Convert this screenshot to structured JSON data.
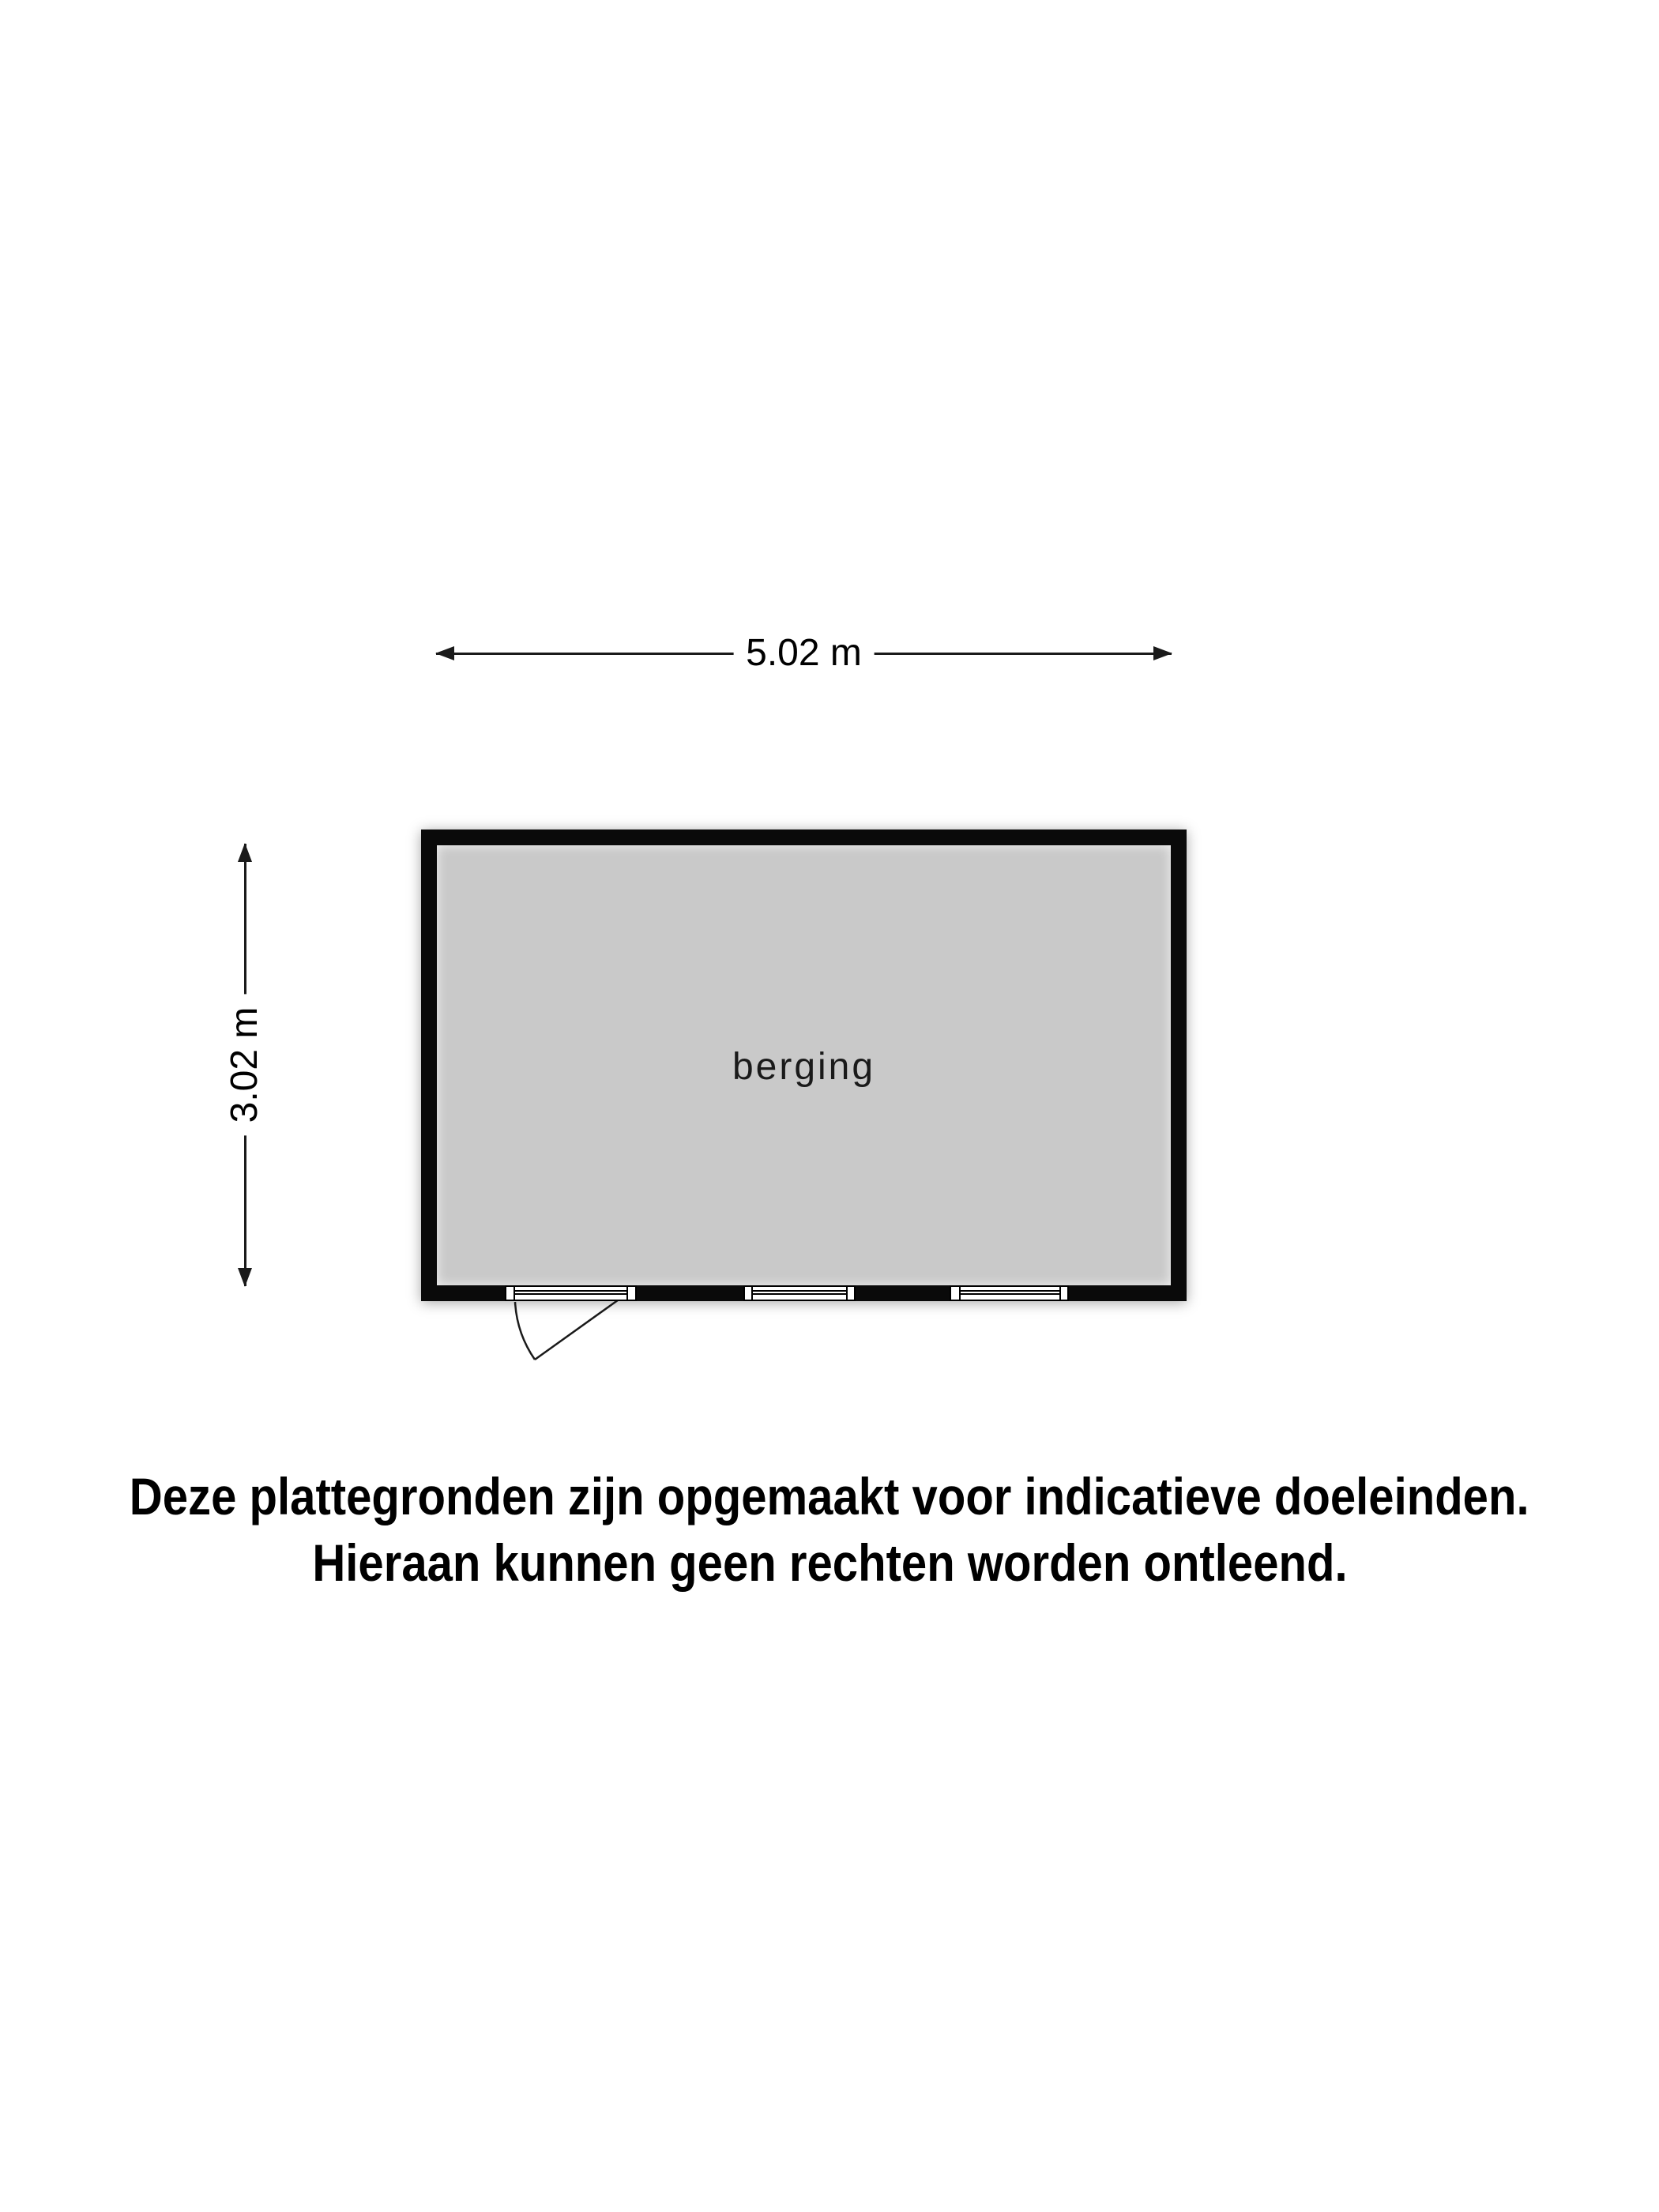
{
  "floorplan": {
    "room_label": "berging",
    "width_dimension": "5.02 m",
    "height_dimension": "3.02 m"
  },
  "disclaimer": {
    "line1": "Deze plattegronden zijn opgemaakt voor indicatieve doeleinden.",
    "line2": "Hieraan kunnen geen rechten worden ontleend."
  },
  "colors": {
    "background": "#ffffff",
    "wall": "#0a0a0a",
    "floor": "#c9c9c9",
    "line": "#1a1a1a",
    "opening": "#ffffff"
  }
}
